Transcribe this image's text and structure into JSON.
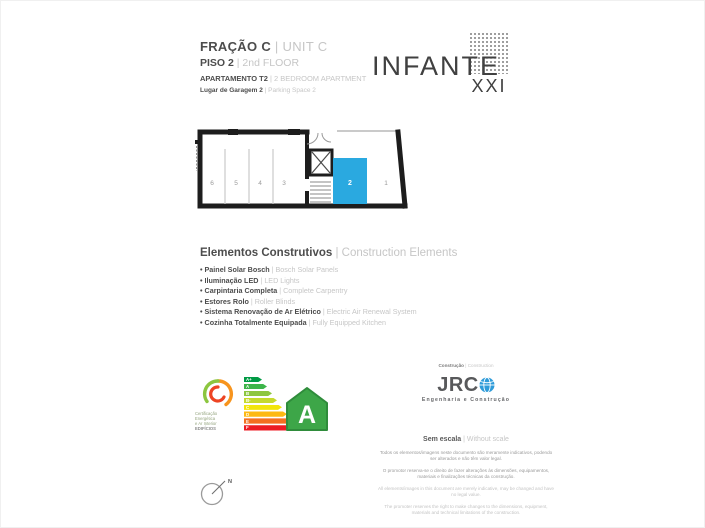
{
  "header": {
    "fraction": {
      "pt": "FRAÇÃO C",
      "en": "UNIT C"
    },
    "floor": {
      "pt": "PISO 2",
      "en": "2nd FLOOR"
    },
    "apartment": {
      "pt": "APARTAMENTO T2",
      "en": "2 BEDROOM APARTMENT"
    },
    "garage": {
      "pt": "Lugar de Garagem 2",
      "en": "Parking Space 2"
    }
  },
  "brand": {
    "name": "INFANTE",
    "numeral": "XXI"
  },
  "floor_plan": {
    "space_labels": [
      "6",
      "5",
      "4",
      "3",
      "2",
      "1"
    ],
    "highlighted_space": "2",
    "highlight_color": "#2AA9E0"
  },
  "construction": {
    "title": {
      "pt": "Elementos Construtivos",
      "en": "Construction Elements"
    },
    "items": [
      {
        "pt": "Painel Solar Bosch",
        "en": "Bosch Solar Panels"
      },
      {
        "pt": "Iluminação LED",
        "en": "LED Lights"
      },
      {
        "pt": "Carpintaria Completa",
        "en": "Complete Carpentry"
      },
      {
        "pt": "Estores Rolo",
        "en": "Roller Blinds"
      },
      {
        "pt": "Sistema Renovação de Ar Elétrico",
        "en": "Electric Air Renewal System"
      },
      {
        "pt": "Cozinha Totalmente Equipada",
        "en": "Fully Equipped Kitchen"
      }
    ]
  },
  "energy": {
    "certification_caption": {
      "line1": "Certificação",
      "line2": "Energética",
      "line3": "e Ar Interior",
      "line4": "EDIFÍCIOS"
    },
    "classes": [
      {
        "label": "A+",
        "color": "#009A44"
      },
      {
        "label": "A",
        "color": "#3DB54A"
      },
      {
        "label": "B",
        "color": "#8DC63F"
      },
      {
        "label": "B-",
        "color": "#C5D92D"
      },
      {
        "label": "C",
        "color": "#F2E50B"
      },
      {
        "label": "D",
        "color": "#FDB913"
      },
      {
        "label": "E",
        "color": "#F37021"
      },
      {
        "label": "F",
        "color": "#EC1C24"
      }
    ],
    "rating": "A",
    "house_fill": "#3DA648",
    "house_stroke": "#2F8C3B"
  },
  "builder": {
    "label": {
      "pt": "Construção",
      "en": "Construction"
    },
    "logo_text": "JRC",
    "tagline": "Engenharia e Construção"
  },
  "scale_note": {
    "pt": "Sem escala",
    "en": "Without scale"
  },
  "disclaimers": {
    "pt1": "Todos os elementos/imagens neste documento são meramente indicativos, podendo ser alterados e não têm valor legal.",
    "pt2": "O promotor reserva-se o direito de fazer alterações às dimensões, equipamentos, materiais e finalizações técnicas da construção.",
    "en1": "All elements/images in this document are merely indicative, may be changed and have no legal value.",
    "en2": "The promoter reserves the right to make changes to the dimensions, equipment, materials and technical limitations of the construction."
  },
  "compass": {
    "north_label": "N"
  }
}
